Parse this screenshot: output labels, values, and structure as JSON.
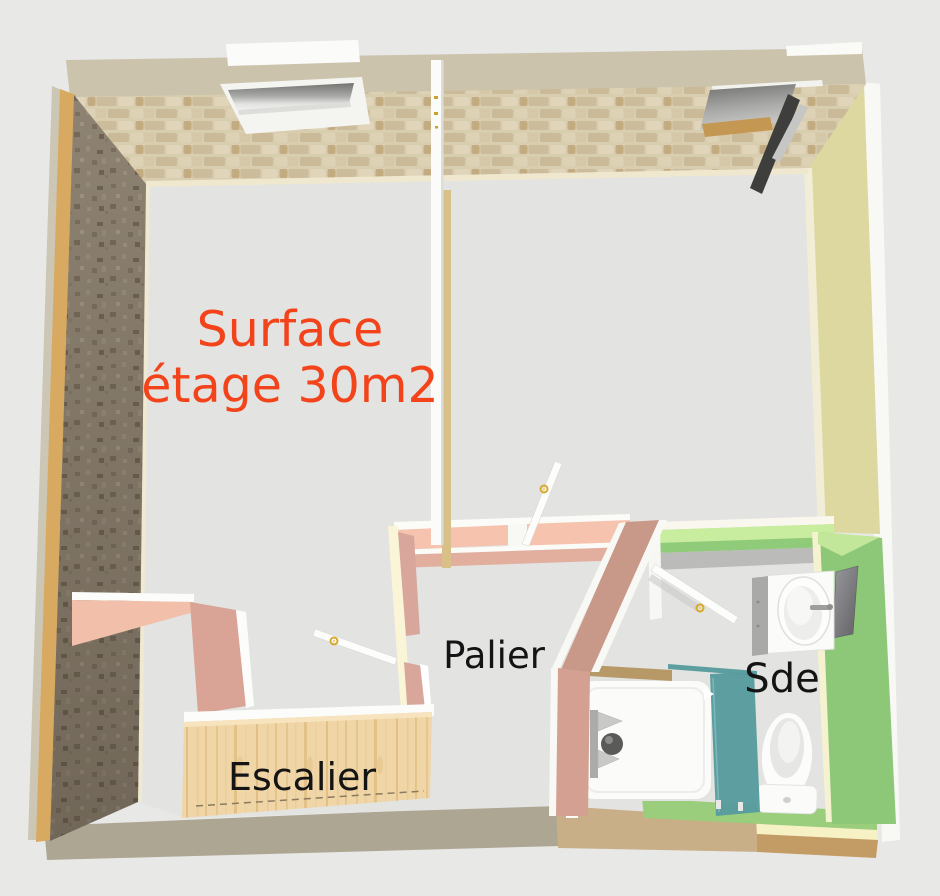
{
  "scene": {
    "description": "3D aerial cutaway view of a house upper floor",
    "background_color": "#E8E8E7"
  },
  "labels": {
    "surface_line1": "Surface",
    "surface_line2": "étage 30m2",
    "surface_color": "#F3431A",
    "palier": "Palier",
    "escalier": "Escalier",
    "sde": "Sde",
    "room_label_color": "#141414"
  },
  "rooms": [
    {
      "name": "main-room",
      "label": "Surface étage 30m2"
    },
    {
      "name": "palier",
      "label": "Palier"
    },
    {
      "name": "escalier",
      "label": "Escalier"
    },
    {
      "name": "sde",
      "label": "Sde"
    }
  ],
  "colors": {
    "ceiling_band": "#CBC3AB",
    "ceiling_brick_base": "#D9CDB0",
    "left_wall_stone": "#8E8372",
    "left_wall_gold_edge": "#D8A961",
    "right_wall_khaki": "#DDD8A0",
    "palier_wall_top_salmon": "#F5C3AE",
    "palier_wall_face_pink": "#D3A091",
    "sde_wall_green": "#8CC877",
    "sde_wall_top_pale_green": "#C9ED9E",
    "sde_floor_green": "#9ACD7C",
    "shower_glass_teal": "#579B9E",
    "stair_wood": "#F0D6A7",
    "floor_gray": "#E3E3E1",
    "door_white": "#FDFDFB",
    "door_handle_gold": "#D9A92F",
    "bottom_wall_gray": "#ADA692",
    "bottom_wall_wood": "#C8AF87",
    "bottom_wall_cream": "#F7F1C6",
    "bottom_wall_brown": "#C29C64"
  },
  "fixtures": [
    {
      "name": "skylight-closed"
    },
    {
      "name": "skylight-open"
    },
    {
      "name": "chimney-flue"
    },
    {
      "name": "door-main-room"
    },
    {
      "name": "door-stairwell"
    },
    {
      "name": "door-sde"
    },
    {
      "name": "stair-guardrail"
    },
    {
      "name": "staircase-escalier"
    },
    {
      "name": "washbasin"
    },
    {
      "name": "mirror"
    },
    {
      "name": "toilet"
    },
    {
      "name": "shower-tray"
    },
    {
      "name": "shower-glass-door"
    }
  ]
}
